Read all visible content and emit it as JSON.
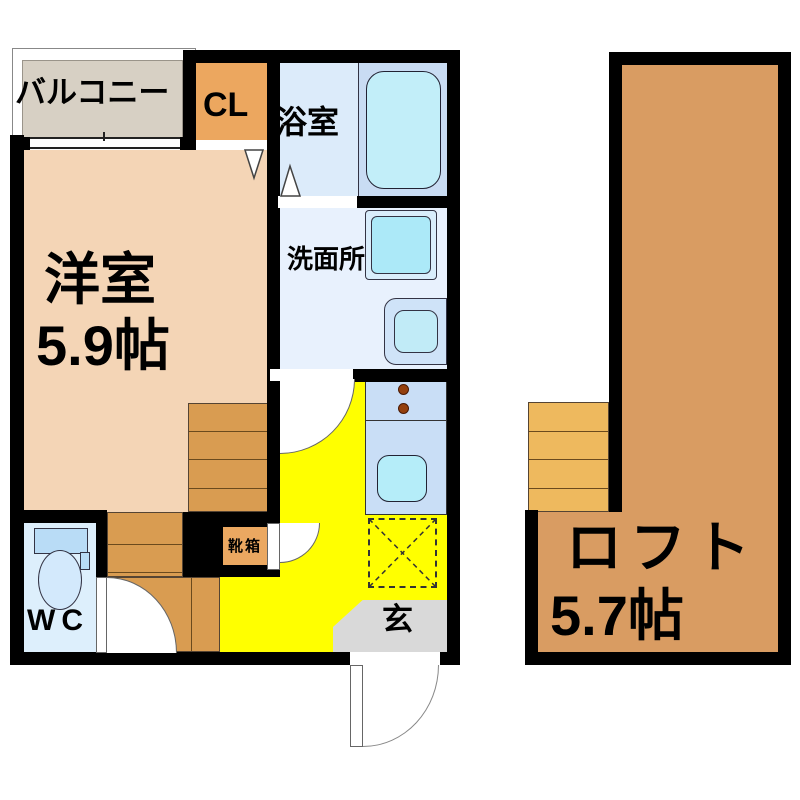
{
  "plan_title": "apartment-floor-plan",
  "rooms": {
    "balcony": {
      "label": "バルコニー"
    },
    "closet": {
      "label": "CL"
    },
    "bathroom": {
      "label": "浴室"
    },
    "washroom": {
      "label": "洗面所"
    },
    "western_room": {
      "label": "洋室",
      "size": "5.9帖"
    },
    "wc": {
      "label": "WC"
    },
    "shoe_box": {
      "label": "靴箱"
    },
    "entrance": {
      "label": "玄"
    },
    "loft": {
      "label": "ロフト",
      "size": "5.7帖"
    }
  },
  "colors": {
    "wall": "#000000",
    "room_peach": "#f4d5b6",
    "closet_orange": "#eca75f",
    "stairs_orange": "#d99c51",
    "loft_orange": "#d99c62",
    "loft_stairs_orange": "#eeb95e",
    "kitchen_yellow": "#ffff00",
    "bathroom_blue": "#dcebfa",
    "tub_zone_blue": "#c9dcf3",
    "fixture_cyan": "#b5edf9",
    "washroom_blue": "#e8f1fd",
    "wc_blue": "#ddeffc",
    "entrance_gray": "#d9d9d9",
    "balcony_beige": "#d7d0c4"
  }
}
